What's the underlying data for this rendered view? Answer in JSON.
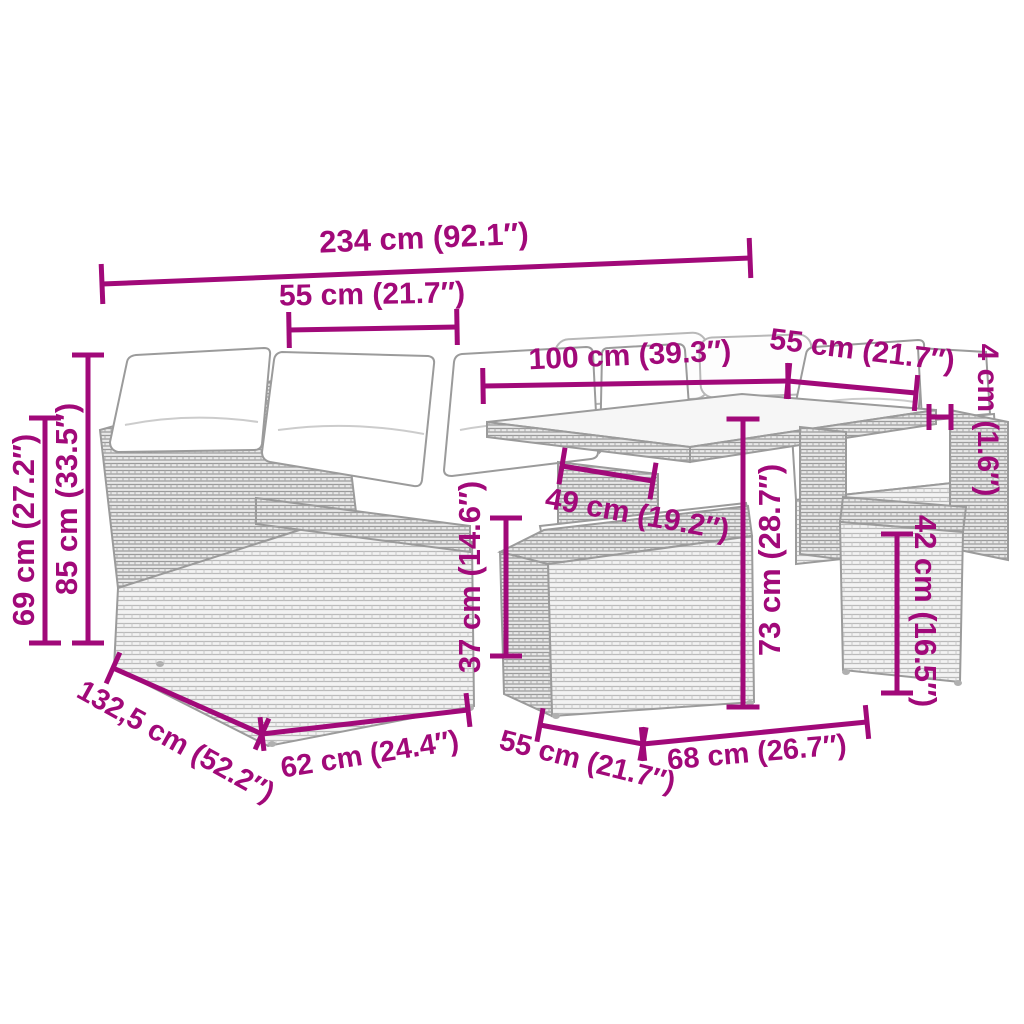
{
  "diagram": {
    "title": "garden-furniture-set-dimension-diagram",
    "product": "Poly rattan garden lounge set with cushions, glass-top table and stools",
    "accent_color": "#A10979",
    "background_color": "#ffffff",
    "furniture_outline_color": "#9b9b9b",
    "cushion_color": "#ffffff",
    "units": [
      "cm",
      "in"
    ],
    "dimensions": [
      {
        "id": "total-width",
        "label": "234 cm (92.1″)",
        "line": {
          "x1": 102,
          "y1": 284,
          "x2": 750,
          "y2": 258
        },
        "tick": 40,
        "label_pos": {
          "x": 424,
          "y": 240,
          "rotate": -2.4
        },
        "font_size": 31
      },
      {
        "id": "left-seat-width",
        "label": "55 cm (21.7″)",
        "line": {
          "x1": 289,
          "y1": 330,
          "x2": 457,
          "y2": 327
        },
        "tick": 36,
        "label_pos": {
          "x": 372,
          "y": 296,
          "rotate": -1
        },
        "font_size": 30
      },
      {
        "id": "table-length",
        "label": "100 cm (39.3″)",
        "line": {
          "x1": 483,
          "y1": 386,
          "x2": 788,
          "y2": 381
        },
        "tick": 36,
        "label_pos": {
          "x": 630,
          "y": 357,
          "rotate": -2.5
        },
        "font_size": 30
      },
      {
        "id": "right-seat-width",
        "label": "55 cm (21.7″)",
        "line": {
          "x1": 788,
          "y1": 381,
          "x2": 916,
          "y2": 393
        },
        "tick": 36,
        "label_pos": {
          "x": 862,
          "y": 352,
          "rotate": 7
        },
        "font_size": 30
      },
      {
        "id": "tabletop-thickness",
        "label": "4 cm (1.6″)",
        "line": {
          "x1": 929,
          "y1": 417,
          "x2": 951,
          "y2": 417
        },
        "tick": 26,
        "label_pos": {
          "x": 986,
          "y": 420,
          "rotate": 90
        },
        "font_size": 30
      },
      {
        "id": "back-height",
        "label": "85 cm (33.5″)",
        "line": {
          "x1": 88,
          "y1": 355,
          "x2": 88,
          "y2": 643
        },
        "tick": 32,
        "label_pos": {
          "x": 69,
          "y": 499,
          "rotate": -90
        },
        "font_size": 31
      },
      {
        "id": "arm-height",
        "label": "69 cm (27.2″)",
        "line": {
          "x1": 45,
          "y1": 418,
          "x2": 45,
          "y2": 643
        },
        "tick": 32,
        "label_pos": {
          "x": 26,
          "y": 530,
          "rotate": -90
        },
        "font_size": 31
      },
      {
        "id": "front-stool-height",
        "label": "37 cm (14.6″)",
        "line": {
          "x1": 506,
          "y1": 518,
          "x2": 506,
          "y2": 656
        },
        "tick": 32,
        "label_pos": {
          "x": 472,
          "y": 577,
          "rotate": -90
        },
        "font_size": 31
      },
      {
        "id": "under-table-width",
        "label": "49 cm (19.2″)",
        "line": {
          "x1": 562,
          "y1": 466,
          "x2": 653,
          "y2": 481
        },
        "tick": 37,
        "label_pos": {
          "x": 637,
          "y": 516,
          "rotate": 10
        },
        "font_size": 30
      },
      {
        "id": "table-height",
        "label": "73 cm (28.7″)",
        "line": {
          "x1": 743,
          "y1": 419,
          "x2": 743,
          "y2": 707
        },
        "tick": 33,
        "label_pos": {
          "x": 772,
          "y": 560,
          "rotate": -90
        },
        "font_size": 31
      },
      {
        "id": "right-stool-height",
        "label": "42 cm (16.5″)",
        "line": {
          "x1": 897,
          "y1": 534,
          "x2": 897,
          "y2": 693
        },
        "tick": 32,
        "label_pos": {
          "x": 923,
          "y": 611,
          "rotate": 90
        },
        "font_size": 31
      },
      {
        "id": "sofa-depth",
        "label": "132,5 cm (52.2″)",
        "line": {
          "x1": 113,
          "y1": 668,
          "x2": 262,
          "y2": 734
        },
        "tick": 34,
        "label_pos": {
          "x": 175,
          "y": 743,
          "rotate": 29
        },
        "font_size": 29
      },
      {
        "id": "corner-module-width",
        "label": "62 cm (24.4″)",
        "line": {
          "x1": 262,
          "y1": 734,
          "x2": 468,
          "y2": 710
        },
        "tick": 34,
        "label_pos": {
          "x": 370,
          "y": 756,
          "rotate": -9
        },
        "font_size": 29
      },
      {
        "id": "front-stool-width",
        "label": "55 cm (21.7″)",
        "line": {
          "x1": 540,
          "y1": 725,
          "x2": 643,
          "y2": 744
        },
        "tick": 34,
        "label_pos": {
          "x": 587,
          "y": 763,
          "rotate": 14
        },
        "font_size": 29
      },
      {
        "id": "table-module-width",
        "label": "68 cm (26.7″)",
        "line": {
          "x1": 643,
          "y1": 744,
          "x2": 867,
          "y2": 722
        },
        "tick": 34,
        "label_pos": {
          "x": 757,
          "y": 754,
          "rotate": -5
        },
        "font_size": 29
      }
    ]
  }
}
